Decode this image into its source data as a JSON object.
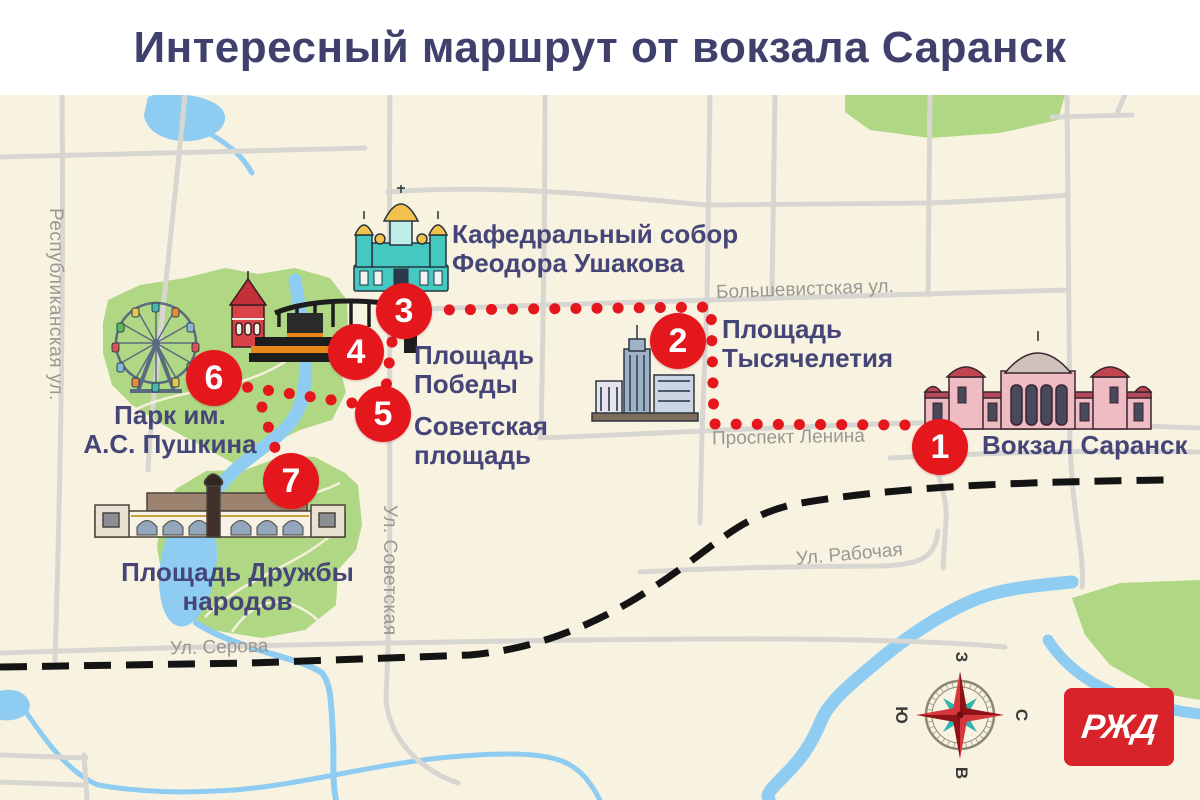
{
  "title": "Интересный маршрут от вокзала Саранск",
  "stops": [
    {
      "number": "1",
      "label": "Вокзал Саранск"
    },
    {
      "number": "2",
      "label": "Площадь\nТысячелетия"
    },
    {
      "number": "3",
      "label": "Кафедральный собор\nФеодора Ушакова"
    },
    {
      "number": "4",
      "label": "Площадь\nПобеды"
    },
    {
      "number": "5",
      "label": "Советская\nплощадь"
    },
    {
      "number": "6",
      "label": "Парк им.\nА.С. Пушкина"
    },
    {
      "number": "7",
      "label": "Площадь Дружбы\nнародов"
    }
  ],
  "streets": {
    "respublikanskaya": "Республиканская ул.",
    "bolshevistskaya": "Большевистская ул.",
    "sovetskaya": "Ул. Советская",
    "prospekt_lenina": "Проспект Ленина",
    "rabochaya": "Ул. Рабочая",
    "serova": "Ул. Серова"
  },
  "compass": {
    "west": "З",
    "north": "С",
    "east": "В",
    "south": "Ю"
  },
  "logo_text": "РЖД",
  "colors": {
    "map_background": "#f8f2e1",
    "park_green": "#b0d783",
    "water_blue": "#8ecdf1",
    "route_red": "#e4171d",
    "label_navy": "#454578",
    "street_gray": "#9a9893",
    "railway_black": "#141414",
    "logo_red": "#d8232a"
  }
}
